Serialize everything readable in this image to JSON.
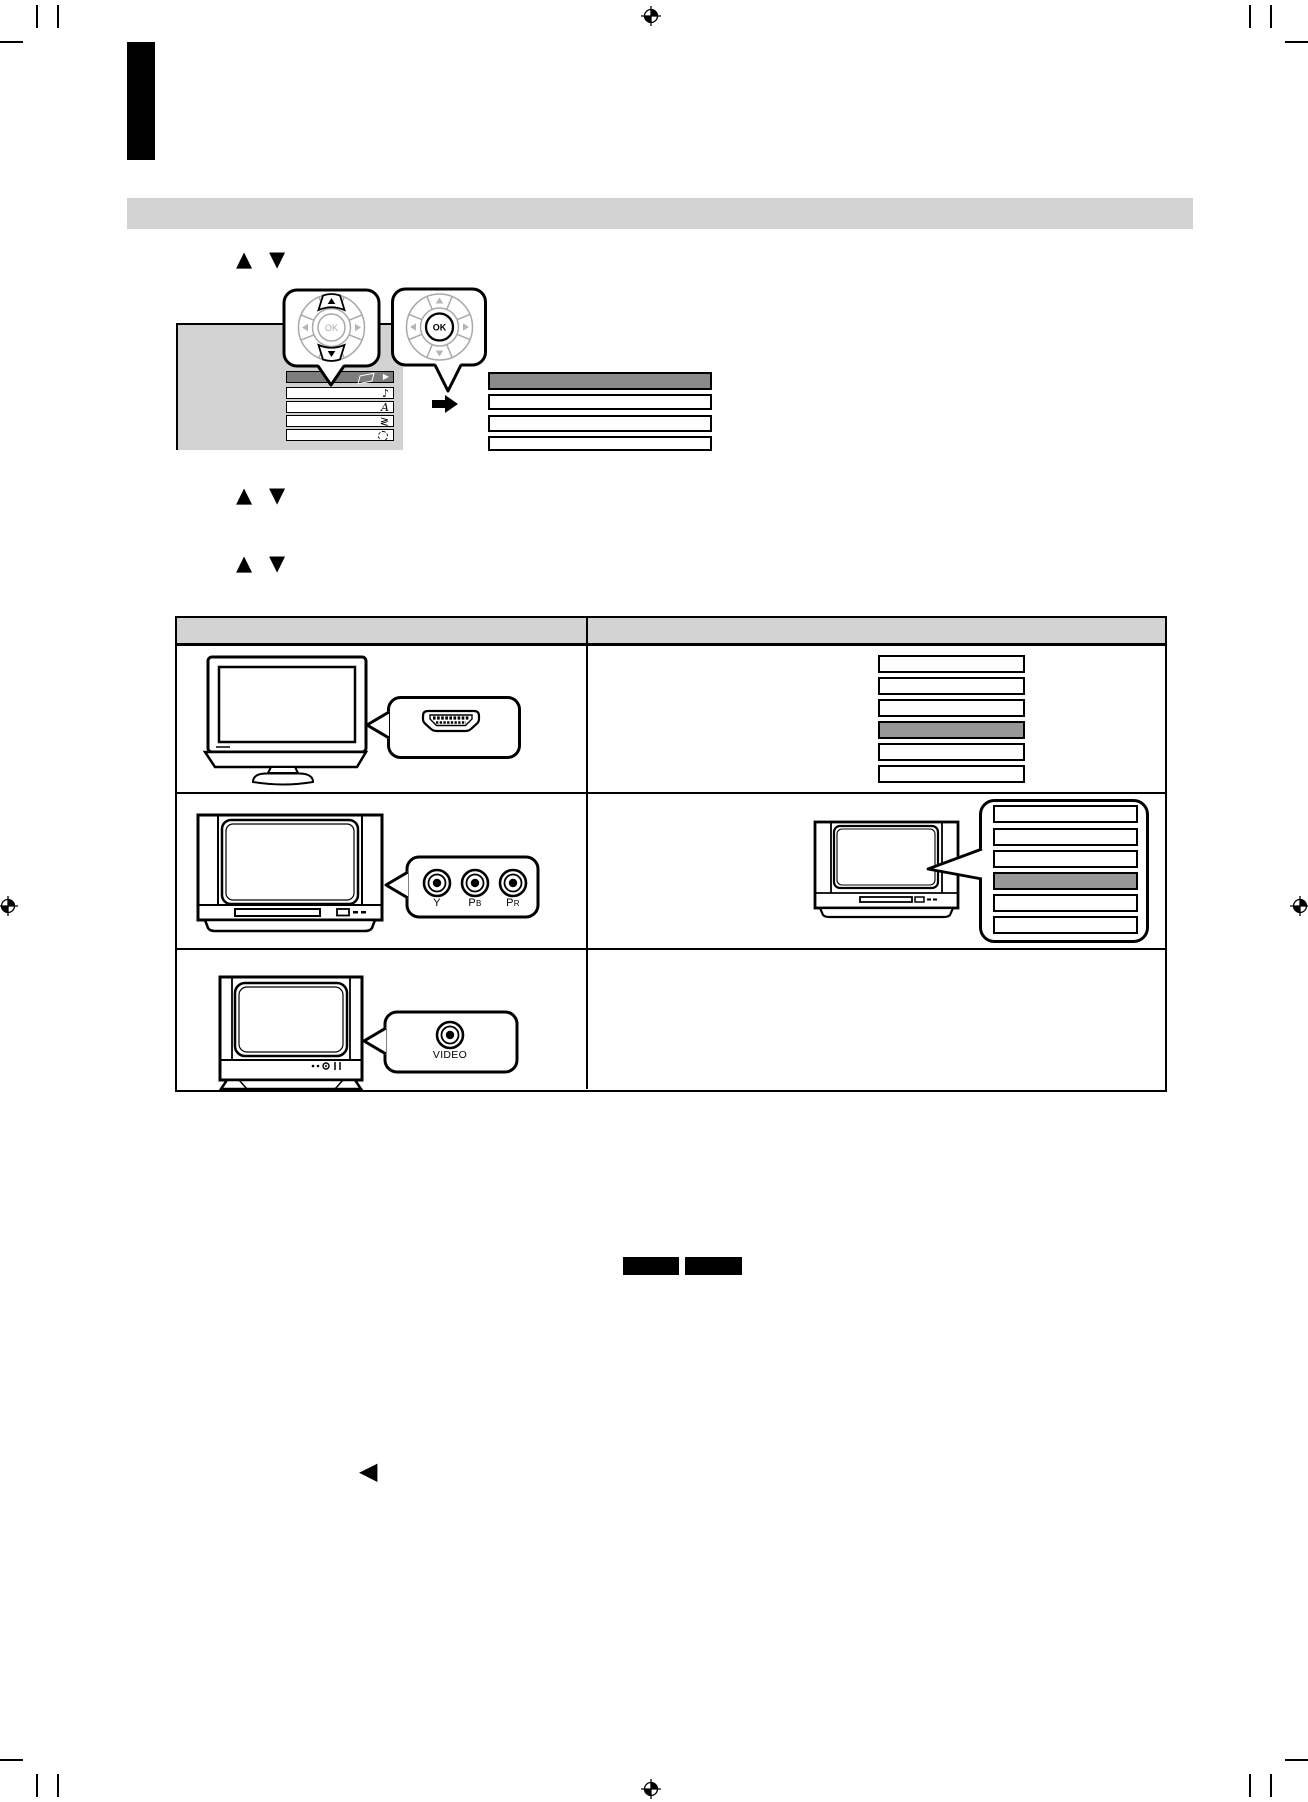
{
  "page": {
    "width": 1308,
    "height": 1802,
    "background": "#ffffff"
  },
  "colors": {
    "section_bar_gray": "#d3d3d3",
    "table_header_gray": "#d3d3d3",
    "menu_panel_gray": "#d2d2d2",
    "menu_highlight_gray": "#7d7d7d",
    "submenu_highlight_gray": "#8a8a8a",
    "list_highlight_gray": "#979797",
    "ink": "#000000",
    "dial_gray": "#a9a9a9"
  },
  "glyphs": {
    "up": "▲",
    "down": "▼",
    "left": "◀",
    "right": "▶",
    "music_note": "♪",
    "letter_a": "A",
    "zigzag": "≷"
  },
  "remote": {
    "ok_label": "OK"
  },
  "figure": {
    "menu_items": [
      {
        "icon": "disc-icon",
        "selected": true
      },
      {
        "icon": "music-note-icon",
        "selected": false
      },
      {
        "icon": "letter-a-icon",
        "selected": false
      },
      {
        "icon": "zigzag-icon",
        "selected": false
      },
      {
        "icon": "dashed-circle-icon",
        "selected": false
      }
    ],
    "submenu": {
      "row_count": 4,
      "selected_row": 1
    }
  },
  "table": {
    "row1": {
      "tv": "flat-panel-tv",
      "connector": "hdmi-port",
      "list": {
        "row_count": 6,
        "selected_row": 4
      }
    },
    "row2": {
      "tv": "widescreen-crt-tv",
      "connector": "component-video-jacks",
      "jack_labels": [
        {
          "main": "Y",
          "sub": ""
        },
        {
          "main": "P",
          "sub": "B"
        },
        {
          "main": "P",
          "sub": "R"
        }
      ],
      "list": {
        "row_count": 6,
        "selected_row": 4
      }
    },
    "row3": {
      "tv": "crt-tv",
      "connector": "composite-video-jack",
      "jack_labels": [
        {
          "main": "VIDEO",
          "sub": ""
        }
      ]
    }
  }
}
